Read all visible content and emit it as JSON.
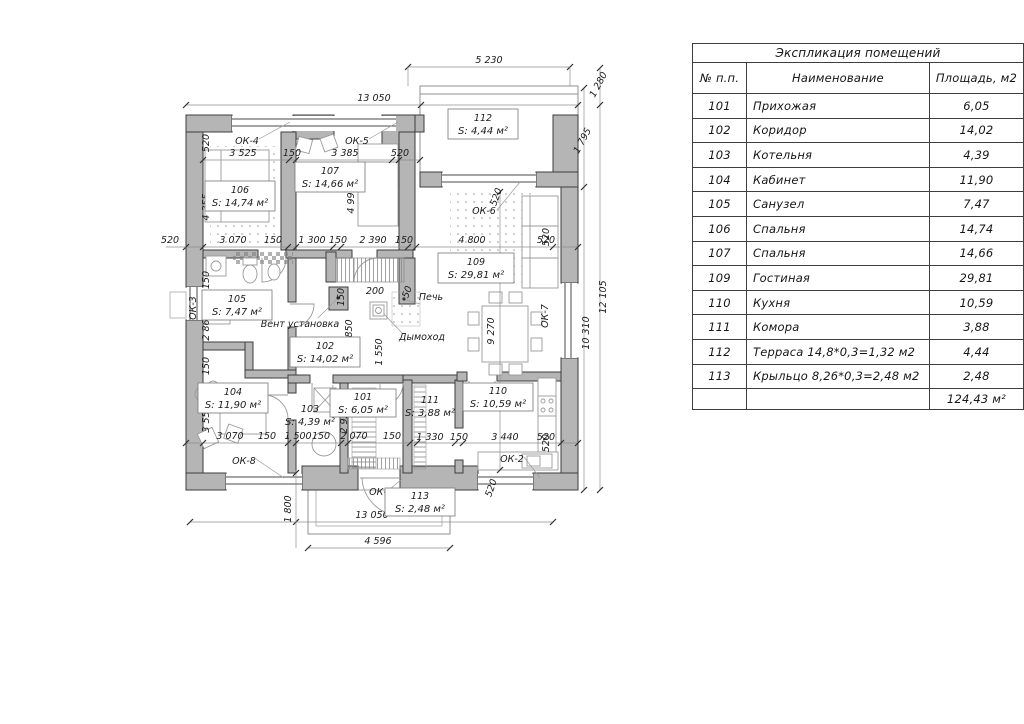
{
  "table": {
    "title": "Экспликация помещений",
    "headers": {
      "num": "№ п.п.",
      "name": "Наименование",
      "area": "Площадь, м2"
    },
    "rows": [
      {
        "num": "101",
        "name": "Прихожая",
        "area": "6,05"
      },
      {
        "num": "102",
        "name": "Коридор",
        "area": "14,02"
      },
      {
        "num": "103",
        "name": "Котельня",
        "area": "4,39"
      },
      {
        "num": "104",
        "name": "Кабинет",
        "area": "11,90"
      },
      {
        "num": "105",
        "name": "Санузел",
        "area": "7,47"
      },
      {
        "num": "106",
        "name": "Спальня",
        "area": "14,74"
      },
      {
        "num": "107",
        "name": "Спальня",
        "area": "14,66"
      },
      {
        "num": "109",
        "name": "Гостиная",
        "area": "29,81"
      },
      {
        "num": "110",
        "name": "Кухня",
        "area": "10,59"
      },
      {
        "num": "111",
        "name": "Комора",
        "area": "3,88"
      },
      {
        "num": "112",
        "name": "Терраса 14,8*0,3=1,32 м2",
        "area": "4,44"
      },
      {
        "num": "113",
        "name": "Крыльцо 8,26*0,3=2,48 м2",
        "area": "2,48"
      }
    ],
    "total": "124,43 м²"
  },
  "plan": {
    "rooms": {
      "r101": {
        "num": "101",
        "area": "S: 6,05 м²"
      },
      "r102": {
        "num": "102",
        "area": "S: 14,02 м²"
      },
      "r103": {
        "num": "103",
        "area": "S: 4,39 м²"
      },
      "r104": {
        "num": "104",
        "area": "S: 11,90 м²"
      },
      "r105": {
        "num": "105",
        "area": "S: 7,47 м²"
      },
      "r106": {
        "num": "106",
        "area": "S: 14,74 м²"
      },
      "r107": {
        "num": "107",
        "area": "S: 14,66 м²"
      },
      "r109": {
        "num": "109",
        "area": "S: 29,81 м²"
      },
      "r110": {
        "num": "110",
        "area": "S: 10,59 м²"
      },
      "r111": {
        "num": "111",
        "area": "S: 3,88 м²"
      },
      "r112": {
        "num": "112",
        "area": "S: 4,44 м²"
      },
      "r113": {
        "num": "113",
        "area": "S: 2,48 м²"
      }
    },
    "windows": {
      "ok1": "ОК-1",
      "ok2": "ОК-2",
      "ok3": "ОК-3",
      "ok4": "ОК-4",
      "ok5": "ОК-5",
      "ok6": "ОК-6",
      "ok7": "ОК-7",
      "ok8": "ОК-8"
    },
    "annotations": {
      "vent": "Вент установка",
      "stove": "Печь",
      "chimney": "Дымоход"
    },
    "dims": {
      "d50": "50",
      "d150": "150",
      "d200": "200",
      "d520": "520",
      "d1280": "1 280",
      "d1300": "1 300",
      "d1330": "1 330",
      "d1500": "1 500",
      "d1550": "1 550",
      "d1795": "1 795",
      "d1800": "1 800",
      "d2070": "2 070",
      "d2390": "2 390",
      "d2850": "2 850",
      "d2860": "2 860",
      "d2925": "2 925",
      "d3070": "3 070",
      "d3385": "3 385",
      "d3440": "3 440",
      "d3525": "3 525",
      "d3555": "3 555",
      "d4355": "4 355",
      "d4596": "4 596",
      "d4800": "4 800",
      "d4995": "4 995",
      "d5230": "5 230",
      "d9270": "9 270",
      "d10310": "10 310",
      "d12105": "12 105",
      "d13050": "13 050"
    }
  },
  "colors": {
    "wall": "#b5b5b5",
    "line": "#3d3d3d",
    "dim": "#8f8f8f"
  }
}
